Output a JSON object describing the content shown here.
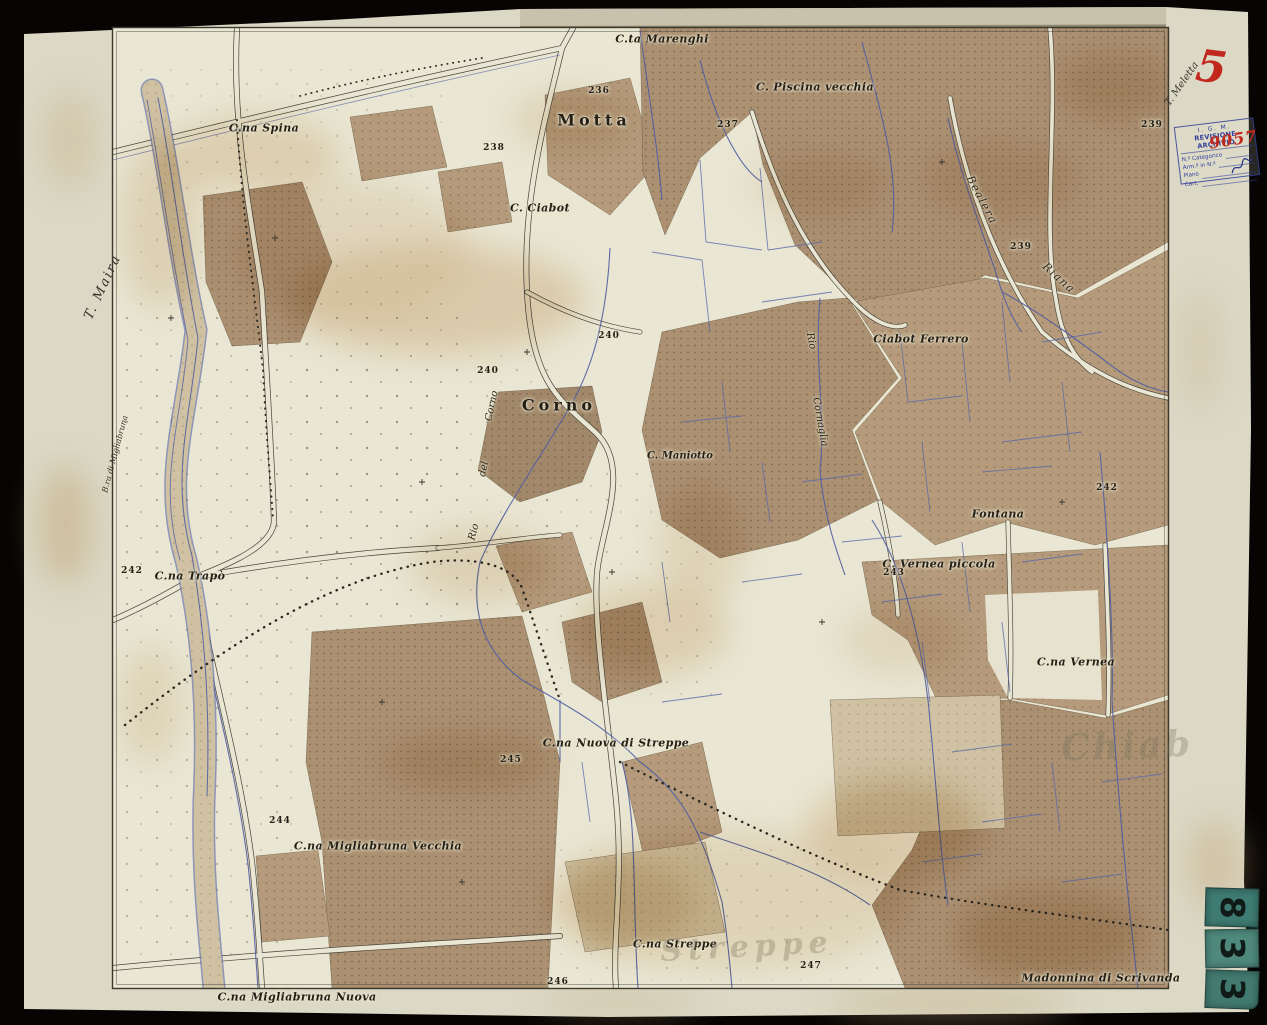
{
  "colors": {
    "ink_red": "#c1271d",
    "stamp_blue": "#32409c",
    "sticker_teal": "#47837a",
    "paper_cream": "#dbd8c5",
    "parcel_brown": "#ab9072",
    "stream_blue": "#4f5da2"
  },
  "sheet": {
    "handwritten_number": "5",
    "stamp": {
      "agency": "I. G. M.",
      "title": "REVISIONE ARCHIVIO",
      "fields": [
        "N.º Categorico",
        "Arm.º in N.º",
        "Piano",
        "Cart."
      ],
      "handwritten_number": "9057"
    },
    "stickers": {
      "digits": [
        "8",
        "3",
        "3"
      ]
    }
  },
  "map": {
    "labels": [
      {
        "id": "cta-marenghi",
        "text": "C.ta Marenghi",
        "x": 662,
        "y": 39,
        "rot": 0,
        "cls": "pl"
      },
      {
        "id": "h236",
        "text": "236",
        "x": 599,
        "y": 91,
        "rot": 0,
        "cls": "num"
      },
      {
        "id": "motta",
        "text": "Motta",
        "x": 594,
        "y": 120,
        "rot": 0,
        "cls": "town"
      },
      {
        "id": "c-piscina-vecchia",
        "text": "C. Piscina vecchia",
        "x": 815,
        "y": 87,
        "rot": 0,
        "cls": "pl"
      },
      {
        "id": "h237",
        "text": "237",
        "x": 728,
        "y": 125,
        "rot": 0,
        "cls": "num"
      },
      {
        "id": "cna-spina",
        "text": "C.na Spina",
        "x": 264,
        "y": 128,
        "rot": 0,
        "cls": "pl"
      },
      {
        "id": "h238",
        "text": "238",
        "x": 494,
        "y": 148,
        "rot": 0,
        "cls": "num"
      },
      {
        "id": "h239-edge",
        "text": "239",
        "x": 1152,
        "y": 125,
        "rot": 0,
        "cls": "num"
      },
      {
        "id": "c-ciabot",
        "text": "C. Ciabot",
        "x": 540,
        "y": 208,
        "rot": 0,
        "cls": "pl"
      },
      {
        "id": "bealera",
        "text": "Bealera",
        "x": 982,
        "y": 200,
        "rot": 62,
        "cls": "wtr"
      },
      {
        "id": "h239",
        "text": "239",
        "x": 1021,
        "y": 247,
        "rot": 0,
        "cls": "num"
      },
      {
        "id": "riana",
        "text": "Riana",
        "x": 1059,
        "y": 278,
        "rot": 42,
        "cls": "wtr"
      },
      {
        "id": "t-maira",
        "text": "T. Maira",
        "x": 103,
        "y": 287,
        "rot": -65,
        "cls": "wtr-lg"
      },
      {
        "id": "t-meletta",
        "text": "T. Meletta",
        "x": 1182,
        "y": 84,
        "rot": -55,
        "cls": "marg"
      },
      {
        "id": "h240a",
        "text": "240",
        "x": 609,
        "y": 336,
        "rot": 0,
        "cls": "num"
      },
      {
        "id": "h240b",
        "text": "240",
        "x": 488,
        "y": 371,
        "rot": 0,
        "cls": "num"
      },
      {
        "id": "ciabot-ferrero",
        "text": "Ciabot Ferrero",
        "x": 921,
        "y": 339,
        "rot": 0,
        "cls": "pl"
      },
      {
        "id": "rio-cornaglia-1",
        "text": "Rio",
        "x": 811,
        "y": 341,
        "rot": 78,
        "cls": "wtr-sm"
      },
      {
        "id": "rio-cornaglia-2",
        "text": "Cornaglia",
        "x": 820,
        "y": 422,
        "rot": 80,
        "cls": "wtr-sm"
      },
      {
        "id": "corno",
        "text": "Corno",
        "x": 559,
        "y": 405,
        "rot": 0,
        "cls": "town"
      },
      {
        "id": "rio-del-corno-3",
        "text": "Corno",
        "x": 492,
        "y": 406,
        "rot": -78,
        "cls": "wtr-sm"
      },
      {
        "id": "rio-del-corno-2",
        "text": "del",
        "x": 484,
        "y": 469,
        "rot": -78,
        "cls": "wtr-sm"
      },
      {
        "id": "rio-del-corno-1",
        "text": "Rio",
        "x": 474,
        "y": 532,
        "rot": -75,
        "cls": "wtr-sm"
      },
      {
        "id": "c-maniotto",
        "text": "C. Maniotto",
        "x": 680,
        "y": 456,
        "rot": 0,
        "cls": "pl-sm"
      },
      {
        "id": "fontana",
        "text": "Fontana",
        "x": 998,
        "y": 514,
        "rot": 0,
        "cls": "pl"
      },
      {
        "id": "h242-right",
        "text": "242",
        "x": 1107,
        "y": 488,
        "rot": 0,
        "cls": "num"
      },
      {
        "id": "c-vernea-piccola",
        "text": "C. Vernea piccola",
        "x": 939,
        "y": 564,
        "rot": 0,
        "cls": "pl"
      },
      {
        "id": "h243",
        "text": "243",
        "x": 894,
        "y": 573,
        "rot": 0,
        "cls": "num"
      },
      {
        "id": "h242-left",
        "text": "242",
        "x": 132,
        "y": 571,
        "rot": 0,
        "cls": "num"
      },
      {
        "id": "cna-trapo",
        "text": "C.na Trapò",
        "x": 190,
        "y": 576,
        "rot": 0,
        "cls": "pl"
      },
      {
        "id": "bra-di-migliabruna",
        "text": "B.ra di Migliabruna",
        "x": 115,
        "y": 454,
        "rot": -75,
        "cls": "wtr-tiny"
      },
      {
        "id": "cna-vernea",
        "text": "C.na Vernea",
        "x": 1076,
        "y": 662,
        "rot": 0,
        "cls": "pl"
      },
      {
        "id": "wm-chiab",
        "text": "Chiab",
        "x": 1127,
        "y": 746,
        "rot": -2,
        "cls": "wm-lg"
      },
      {
        "id": "cna-nuova-di-streppe",
        "text": "C.na Nuova di Streppe",
        "x": 616,
        "y": 743,
        "rot": 0,
        "cls": "pl"
      },
      {
        "id": "h245",
        "text": "245",
        "x": 511,
        "y": 760,
        "rot": 0,
        "cls": "num"
      },
      {
        "id": "h244",
        "text": "244",
        "x": 280,
        "y": 821,
        "rot": 0,
        "cls": "num"
      },
      {
        "id": "cna-migliabruna-vecchia",
        "text": "C.na Migliabruna Vecchia",
        "x": 378,
        "y": 846,
        "rot": 0,
        "cls": "pl"
      },
      {
        "id": "cna-streppe",
        "text": "C.na Streppe",
        "x": 675,
        "y": 944,
        "rot": 0,
        "cls": "pl"
      },
      {
        "id": "wm-streppe",
        "text": "Streppe",
        "x": 747,
        "y": 947,
        "rot": -3,
        "cls": "wm"
      },
      {
        "id": "h246",
        "text": "246",
        "x": 558,
        "y": 982,
        "rot": 0,
        "cls": "num"
      },
      {
        "id": "h247",
        "text": "247",
        "x": 811,
        "y": 966,
        "rot": 0,
        "cls": "num"
      },
      {
        "id": "madonnina-di-scrivanda",
        "text": "Madonnina di Scrivanda",
        "x": 1101,
        "y": 978,
        "rot": 0,
        "cls": "pl"
      },
      {
        "id": "cna-migliabruna-nuova",
        "text": "C.na Migliabruna Nuova",
        "x": 297,
        "y": 997,
        "rot": 0,
        "cls": "pl"
      }
    ]
  }
}
